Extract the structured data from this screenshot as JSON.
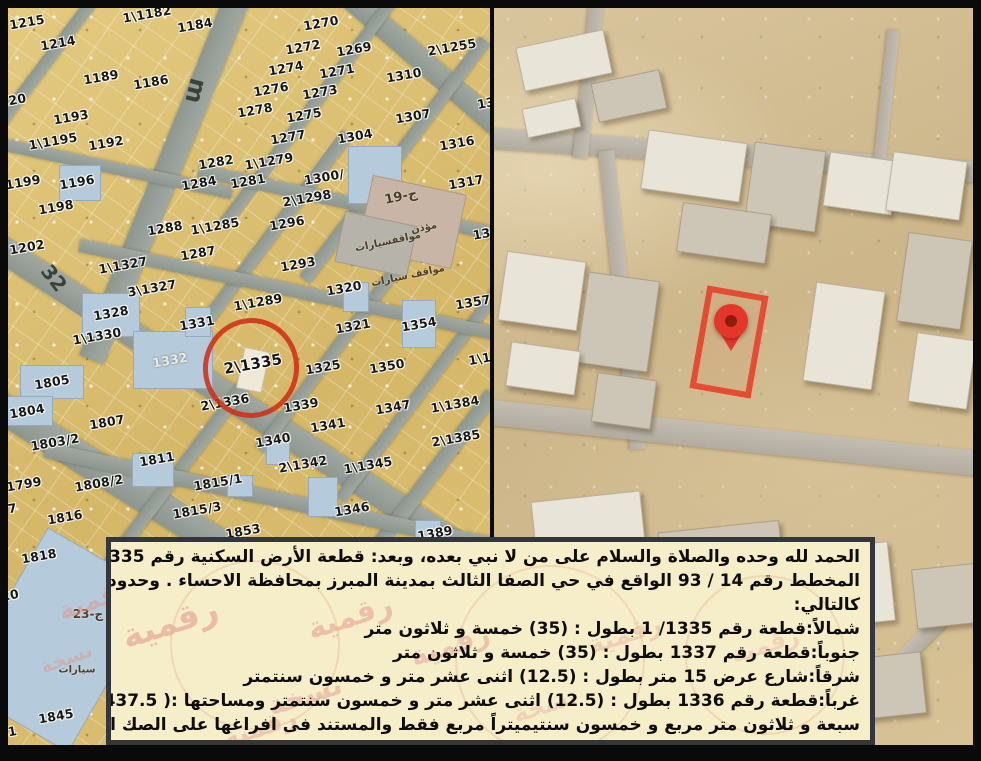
{
  "document": {
    "type_label": "صك عقاري - كروكي الموقع",
    "highlighted_parcel": "2\\1335",
    "accent_red": "#cf2f16",
    "deed_box_bg": "#f6eec9"
  },
  "deed": {
    "lines": [
      "الحمد لله وحده والصلاة والسلام على من لا نبي بعده، وبعد: قطعة الأرض السكنية رقم 1335 / 2 من",
      "المخطط رقم 14 / 93 الواقع في حي الصفا الثالث بمدينة المبرز بمحافظة الاحساء . وحدودها وأطوالها",
      "كالتالي:",
      "شمالاً:قطعة رقم 1335/ 1 بطول : (35) خمسة و ثلاثون متر",
      "جنوباً:قطعة رقم 1337 بطول : (35) خمسة و ثلاثون متر",
      "شرقاً:شارع عرض 15 متر بطول : (12.5) اثنى عشر متر و خمسون سنتمتر",
      "غرباً:قطعة رقم 1336 بطول : (12.5) اثنى عشر متر و خمسون سنتمتر ومساحتها :( 437.5) أربعمائة و",
      "سبعة و ثلاثون متر مربع و خمسون سنتيميتراً مربع فقط والمستند فى افراغها على الصك الصادر من برقم"
    ]
  },
  "left_map": {
    "street_labels": [
      {
        "t": "m",
        "x": 196,
        "y": 91,
        "r": 104,
        "s": 24
      },
      {
        "t": "32",
        "x": 54,
        "y": 278,
        "r": 52,
        "s": 20
      }
    ],
    "area_labels": [
      {
        "t": "مواقفسيارات",
        "x": 388,
        "y": 242,
        "r": -12,
        "s": 10
      },
      {
        "t": "مواقف سيارات",
        "x": 408,
        "y": 276,
        "r": -12,
        "s": 10
      },
      {
        "t": "ج-19",
        "x": 401,
        "y": 197,
        "r": -12,
        "s": 13
      },
      {
        "t": "مؤذن",
        "x": 424,
        "y": 228,
        "r": -12,
        "s": 10
      },
      {
        "t": "ج-23",
        "x": 88,
        "y": 614,
        "r": 0,
        "s": 12
      },
      {
        "t": "سيارات",
        "x": 77,
        "y": 670,
        "r": 0,
        "s": 10
      }
    ],
    "parcels": [
      {
        "t": "1215",
        "x": 27,
        "y": 22
      },
      {
        "t": "1214",
        "x": 58,
        "y": 43
      },
      {
        "t": "1\\1182",
        "x": 147,
        "y": 14
      },
      {
        "t": "1184",
        "x": 195,
        "y": 25
      },
      {
        "t": "1189",
        "x": 101,
        "y": 77
      },
      {
        "t": "1186",
        "x": 151,
        "y": 82
      },
      {
        "t": "220",
        "x": 13,
        "y": 100
      },
      {
        "t": "1193",
        "x": 71,
        "y": 117
      },
      {
        "t": "1\\1195",
        "x": 53,
        "y": 141
      },
      {
        "t": "1192",
        "x": 106,
        "y": 143
      },
      {
        "t": "1199",
        "x": 23,
        "y": 182
      },
      {
        "t": "1196",
        "x": 77,
        "y": 182
      },
      {
        "t": "1198",
        "x": 56,
        "y": 207
      },
      {
        "t": "1202",
        "x": 27,
        "y": 247
      },
      {
        "t": "1282",
        "x": 216,
        "y": 162
      },
      {
        "t": "1284",
        "x": 199,
        "y": 183
      },
      {
        "t": "1281",
        "x": 248,
        "y": 181
      },
      {
        "t": "1288",
        "x": 165,
        "y": 228
      },
      {
        "t": "1\\1285",
        "x": 215,
        "y": 226
      },
      {
        "t": "1287",
        "x": 198,
        "y": 253
      },
      {
        "t": "1270",
        "x": 321,
        "y": 23
      },
      {
        "t": "1272",
        "x": 303,
        "y": 47
      },
      {
        "t": "1269",
        "x": 354,
        "y": 49
      },
      {
        "t": "2\\1255",
        "x": 452,
        "y": 47
      },
      {
        "t": "1274",
        "x": 286,
        "y": 68
      },
      {
        "t": "1271",
        "x": 337,
        "y": 71
      },
      {
        "t": "1310",
        "x": 404,
        "y": 75
      },
      {
        "t": "1276",
        "x": 271,
        "y": 89
      },
      {
        "t": "1273",
        "x": 320,
        "y": 92
      },
      {
        "t": "1278",
        "x": 255,
        "y": 110
      },
      {
        "t": "1275",
        "x": 304,
        "y": 115
      },
      {
        "t": "1307",
        "x": 413,
        "y": 116
      },
      {
        "t": "13",
        "x": 486,
        "y": 103
      },
      {
        "t": "1277",
        "x": 288,
        "y": 137
      },
      {
        "t": "1304",
        "x": 355,
        "y": 136
      },
      {
        "t": "1316",
        "x": 457,
        "y": 143
      },
      {
        "t": "1\\1279",
        "x": 269,
        "y": 161
      },
      {
        "t": "1300/",
        "x": 324,
        "y": 177
      },
      {
        "t": "1317",
        "x": 466,
        "y": 182
      },
      {
        "t": "2\\1298",
        "x": 307,
        "y": 198
      },
      {
        "t": "1296",
        "x": 287,
        "y": 223
      },
      {
        "t": "136",
        "x": 486,
        "y": 233
      },
      {
        "t": "1293",
        "x": 298,
        "y": 264
      },
      {
        "t": "1\\1327",
        "x": 123,
        "y": 265
      },
      {
        "t": "3\\1327",
        "x": 152,
        "y": 288
      },
      {
        "t": "1328",
        "x": 111,
        "y": 313
      },
      {
        "t": "1331",
        "x": 197,
        "y": 323
      },
      {
        "t": "1\\1330",
        "x": 97,
        "y": 336
      },
      {
        "t": "1332",
        "x": 170,
        "y": 360,
        "c": "light"
      },
      {
        "t": "1\\1289",
        "x": 258,
        "y": 302
      },
      {
        "t": "1320",
        "x": 344,
        "y": 288
      },
      {
        "t": "1321",
        "x": 353,
        "y": 326
      },
      {
        "t": "1354",
        "x": 419,
        "y": 324
      },
      {
        "t": "1357",
        "x": 473,
        "y": 302
      },
      {
        "t": "2\\1335",
        "x": 253,
        "y": 364,
        "s": 15
      },
      {
        "t": "1325",
        "x": 323,
        "y": 367
      },
      {
        "t": "1350",
        "x": 387,
        "y": 366
      },
      {
        "t": "1\\13",
        "x": 484,
        "y": 358
      },
      {
        "t": "1805",
        "x": 52,
        "y": 382
      },
      {
        "t": "1804",
        "x": 27,
        "y": 411
      },
      {
        "t": "2\\1336",
        "x": 225,
        "y": 402
      },
      {
        "t": "1339",
        "x": 301,
        "y": 405
      },
      {
        "t": "1347",
        "x": 393,
        "y": 407
      },
      {
        "t": "1\\1384",
        "x": 455,
        "y": 404
      },
      {
        "t": "1807",
        "x": 107,
        "y": 422
      },
      {
        "t": "1803/2",
        "x": 55,
        "y": 442
      },
      {
        "t": "1341",
        "x": 328,
        "y": 425
      },
      {
        "t": "1340",
        "x": 273,
        "y": 440
      },
      {
        "t": "2\\1385",
        "x": 456,
        "y": 438
      },
      {
        "t": "1811",
        "x": 157,
        "y": 459
      },
      {
        "t": "2\\1342",
        "x": 303,
        "y": 464
      },
      {
        "t": "1\\1345",
        "x": 368,
        "y": 465
      },
      {
        "t": "1799",
        "x": 24,
        "y": 484
      },
      {
        "t": "1808/2",
        "x": 99,
        "y": 483
      },
      {
        "t": "1815/1",
        "x": 218,
        "y": 482
      },
      {
        "t": "97",
        "x": 8,
        "y": 509
      },
      {
        "t": "1815/3",
        "x": 197,
        "y": 510
      },
      {
        "t": "1816",
        "x": 65,
        "y": 517
      },
      {
        "t": "1853",
        "x": 243,
        "y": 531
      },
      {
        "t": "1346",
        "x": 352,
        "y": 509
      },
      {
        "t": "1389",
        "x": 435,
        "y": 533
      },
      {
        "t": "1818",
        "x": 39,
        "y": 556
      },
      {
        "t": "20",
        "x": 10,
        "y": 595
      },
      {
        "t": "1845",
        "x": 56,
        "y": 716
      },
      {
        "t": "41",
        "x": 8,
        "y": 732
      }
    ]
  },
  "right_map": {
    "plot_outline_color": "#e73a25",
    "pin_color": "#e6362a"
  },
  "watermark": {
    "color": "#e2928a",
    "map_instances": [
      {
        "t": "رقمية",
        "x": 95,
        "y": 600,
        "r": -20,
        "s": 26,
        "o": 0.5
      },
      {
        "t": "نسخة",
        "x": 66,
        "y": 658,
        "r": -20,
        "s": 20,
        "o": 0.45
      }
    ],
    "box_instances": [
      {
        "t": "رقمية",
        "x": 59,
        "y": 81,
        "r": -18,
        "s": 34,
        "o": 0.55
      },
      {
        "t": "رقمية",
        "x": 239,
        "y": 75,
        "r": -18,
        "s": 30,
        "o": 0.5
      },
      {
        "t": "نسخة",
        "x": 194,
        "y": 153,
        "r": -18,
        "s": 28,
        "o": 0.45
      },
      {
        "t": "رقمية",
        "x": 339,
        "y": 103,
        "r": -18,
        "s": 28,
        "o": 0.45
      },
      {
        "t": "رقمية",
        "x": 149,
        "y": 186,
        "r": -18,
        "s": 26,
        "o": 0.4
      },
      {
        "t": "رقمية",
        "x": 514,
        "y": 93,
        "r": -18,
        "s": 26,
        "o": 0.32
      },
      {
        "t": "نسخة",
        "x": 434,
        "y": 163,
        "r": -18,
        "s": 24,
        "o": 0.3
      },
      {
        "t": "رقمية",
        "x": 654,
        "y": 103,
        "r": -18,
        "s": 24,
        "o": 0.28
      }
    ]
  }
}
